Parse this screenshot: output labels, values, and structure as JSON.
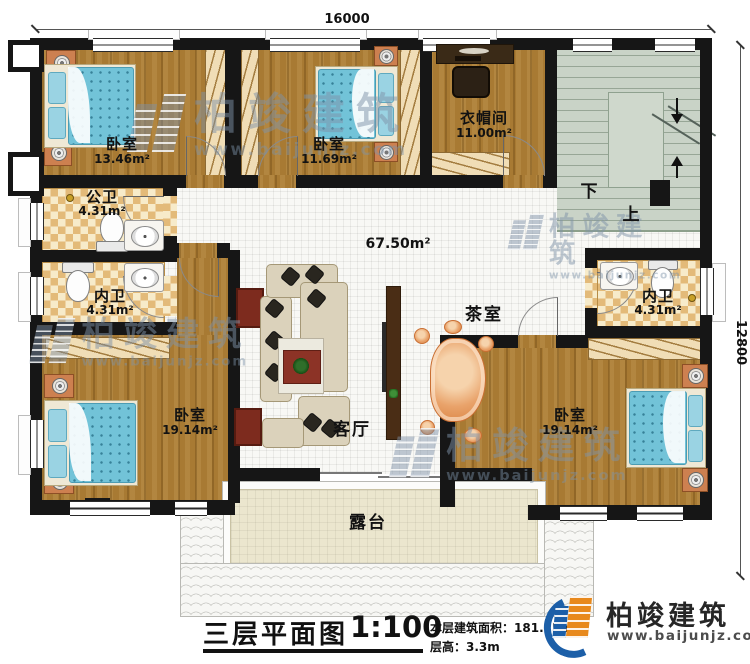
{
  "dimensions": {
    "width": "16000",
    "depth": "12800"
  },
  "rooms": {
    "bedroom_tl": {
      "name": "卧室",
      "area": "13.46m²"
    },
    "bedroom_tm": {
      "name": "卧室",
      "area": "11.69m²"
    },
    "cloakroom": {
      "name": "衣帽间",
      "area": "11.00m²"
    },
    "public_bath": {
      "name": "公卫",
      "area": "4.31m²"
    },
    "ensuite_left": {
      "name": "内卫",
      "area": "4.31m²"
    },
    "ensuite_right": {
      "name": "内卫",
      "area": "4.31m²"
    },
    "bedroom_bl": {
      "name": "卧室",
      "area": "19.14m²"
    },
    "bedroom_br": {
      "name": "卧室",
      "area": "19.14m²"
    },
    "hall": {
      "area": "67.50m²"
    },
    "tea_room": {
      "name": "茶室"
    },
    "living_room": {
      "name": "客厅"
    },
    "terrace": {
      "name": "露台"
    }
  },
  "stairs": {
    "down": "下",
    "up": "上"
  },
  "title_block": {
    "title": "三层平面图",
    "scale": "1:100",
    "area_label": "本层建筑面积：",
    "area_value": "181.75m²",
    "height_label": "层高：",
    "height_value": "3.3m"
  },
  "branding": {
    "company": "柏竣建筑",
    "website": "www.baijunjz.com"
  },
  "watermark": {
    "company": "柏竣建筑",
    "website": "www.baijunjz.com"
  },
  "colors": {
    "wall": "#161616",
    "wood": "#a87a33",
    "checker": "#e3ba79",
    "stair": "#c9d3c7",
    "terrace": "#ebe6ce",
    "bed": "#72c3d8",
    "logo_blue": "#1c5fa8",
    "logo_orange": "#e8891c"
  }
}
